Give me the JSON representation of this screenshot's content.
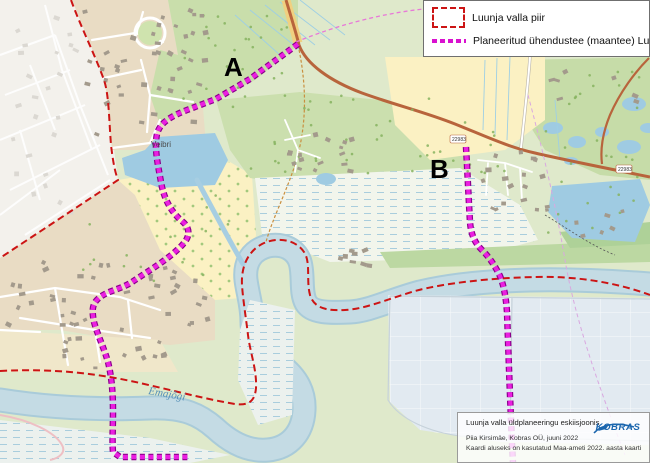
{
  "legend": {
    "items": [
      {
        "id": "municipal-border",
        "label": "Luunja valla piir"
      },
      {
        "id": "planned-road",
        "label": "Planeeritud ühendustee (maantee) Luunja vallaga"
      }
    ]
  },
  "map_labels": {
    "marker_a": "A",
    "marker_b": "B",
    "river": "Emajõgi",
    "village": "Veibri",
    "road_number": "22983"
  },
  "info_box": {
    "title": "Luunja valla üldplaneeringu eskiisjoonis",
    "credit": "Piia Kirsimäe, Kobras OÜ, juuni 2022",
    "source": "Kaardi aluseks on kasutatud Maa-ameti 2022. aasta kaarti",
    "logo": "KOBRAS"
  },
  "colors": {
    "border_red": "#cc1414",
    "planned_road_magenta": "#d911cf",
    "water": "#a7cee2",
    "forest": "#cde0b0",
    "field": "#fbf1c3",
    "logo_blue": "#1b66ae"
  }
}
